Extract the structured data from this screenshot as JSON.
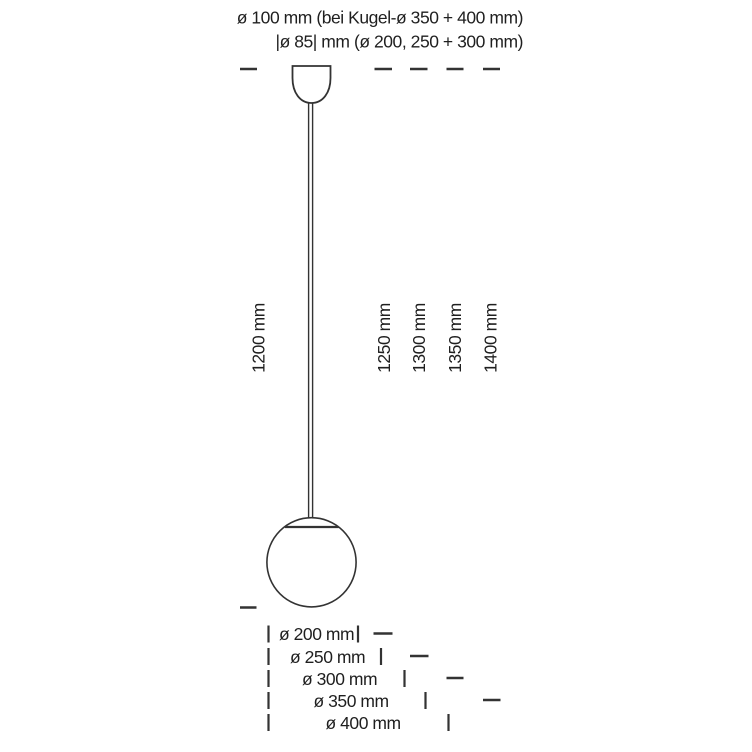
{
  "diagram": {
    "top_notes": {
      "line1": "ø 100 mm (bei Kugel-ø 350 + 400 mm)",
      "line2": "|ø 85| mm (ø 200, 250 + 300 mm)"
    },
    "suspension_lengths": {
      "cable": "1200 mm",
      "totals": [
        "1250 mm",
        "1300 mm",
        "1350 mm",
        "1400 mm"
      ]
    },
    "sphere_diameters": [
      "ø 200 mm",
      "ø 250 mm",
      "ø 300 mm",
      "ø 350 mm",
      "ø 400 mm"
    ],
    "colors": {
      "line": "#333333",
      "text": "#1f1f1f",
      "background": "#ffffff"
    }
  }
}
